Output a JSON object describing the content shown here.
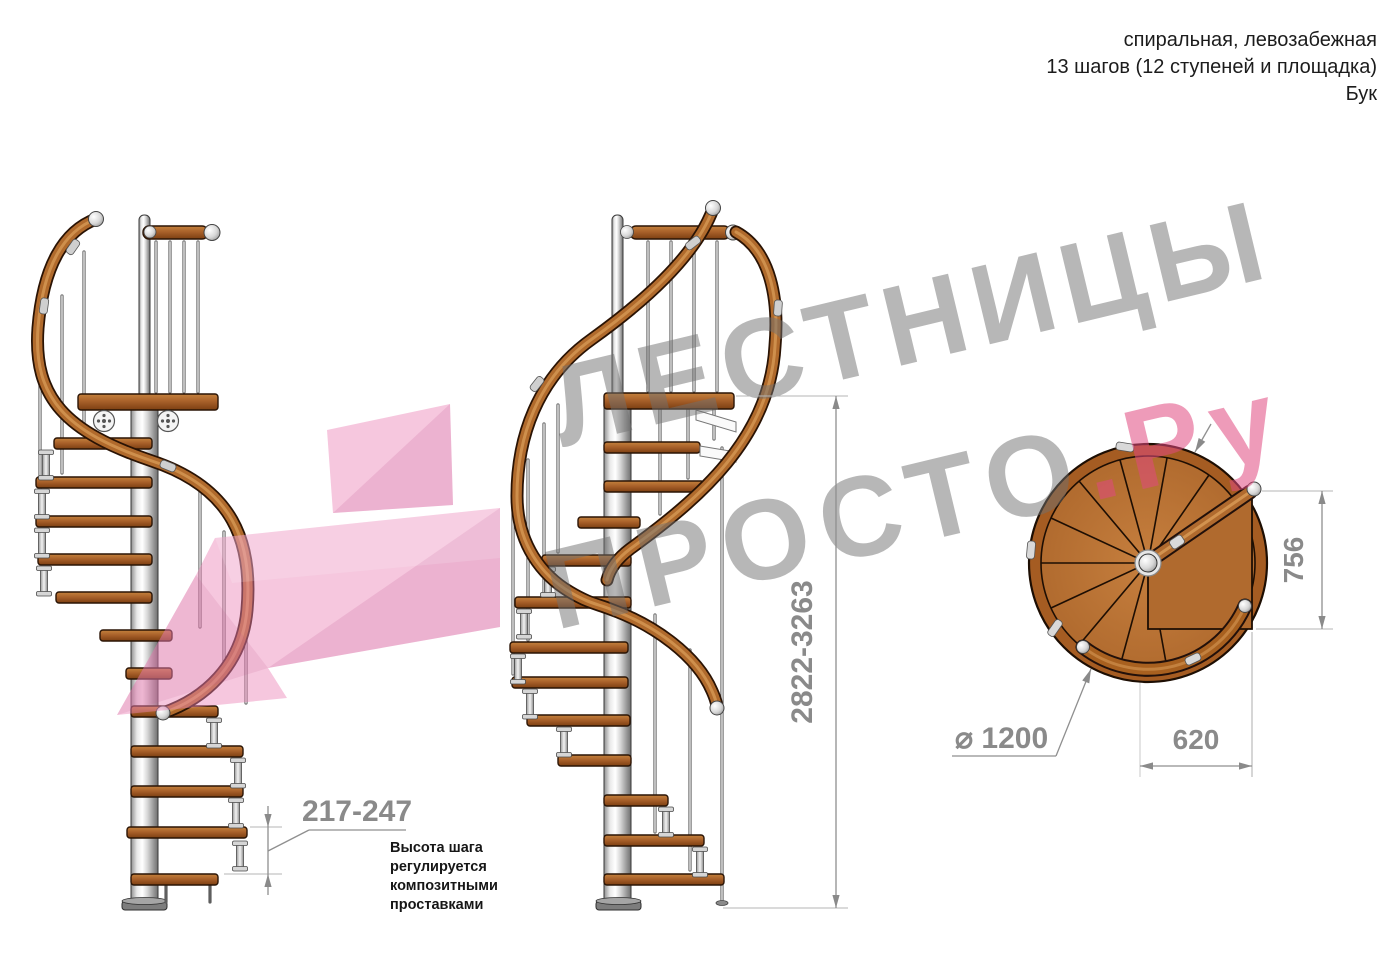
{
  "header": {
    "line1": "спиральная, левозабежная",
    "line2": "13 шагов (12 ступеней и площадка)",
    "line3": "Бук"
  },
  "watermark": {
    "line1": "ЛЕСТНИЦЫ",
    "line2_gray": "ПРОСТО",
    "line2_pink": ".Ру"
  },
  "dimensions": {
    "total_height": "2822-3263",
    "step_height": "217-247",
    "landing_depth": "756",
    "landing_width": "620",
    "diameter": "⌀ 1200"
  },
  "note": {
    "line1": "Высота шага",
    "line2": "регулируется",
    "line3": "композитными",
    "line4": "проставками"
  },
  "colors": {
    "watermark_gray": "#6f6f6f",
    "watermark_pink": "#e04880",
    "arrow_pink": "#ec82b6",
    "wood": "#a9612a",
    "wood_dark": "#7c3f12",
    "chrome": "#e9e9e9",
    "dimension_gray": "#8a8a8a"
  }
}
